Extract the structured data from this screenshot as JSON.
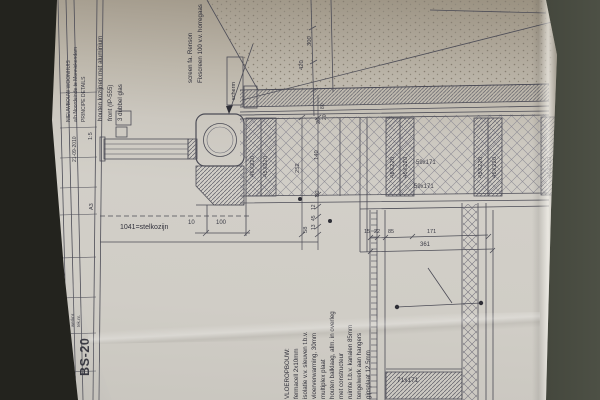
{
  "colors": {
    "paper": "#d0cdc6",
    "background_left": "#23231e",
    "background_right": "#4a4d42",
    "line": "#4c4c56"
  },
  "title_block": {
    "project_lines": [
      "NIEUWBOUW WOONHUIS",
      "a/h Noordeinde te Monnickendam",
      "PRINCIPE DETAILS"
    ],
    "schaal": "1:5",
    "formaat": "A3",
    "datum": "21-09-2010",
    "werknr_label": "werknr.",
    "teknr_label": "tek.nr.",
    "drawing_number": "BS-20"
  },
  "notes": {
    "window_note": [
      "houten kozijnen met aluminium",
      "front (IP-555)",
      "3 dubbel glas"
    ],
    "screen_note": [
      "screen fa. Renson",
      "Fixscreen 100 v.v. horregaas"
    ],
    "scherm_label": "scherm",
    "stelkozijn_label": "1041=stelkozijn",
    "floor_note": [
      "VLOEROPBOUW:",
      "fermacell 2x10mm",
      "isolatie v.v. sleuven t.b.v.",
      "vloerverwarming, 30mm",
      "multiplex plaat",
      "houten balklaag, afm. in overleg",
      "met constructeur",
      "ruimte t.b.v. kanalen 85mm",
      "tengelwerk aan hangers",
      "gipsplaat 12.5mm"
    ]
  },
  "dims": {
    "top_300": "300",
    "top_420": "420",
    "chain": [
      "20",
      "140",
      "80",
      "12",
      "45",
      "13",
      "58"
    ],
    "overall": "252",
    "upper_small": [
      "80",
      "20"
    ],
    "stelkozijn_offset": "10",
    "stelkozijn_width": "100",
    "beams": [
      "46X220",
      "45X220",
      "46X220",
      "45X220",
      "45X220",
      "45X220",
      "45X220"
    ],
    "joists": [
      "59x171",
      "59x171"
    ],
    "bottom_chain": [
      "15",
      "22",
      "85",
      "171"
    ],
    "bottom_total": "361",
    "footer_beam": "71x171"
  }
}
